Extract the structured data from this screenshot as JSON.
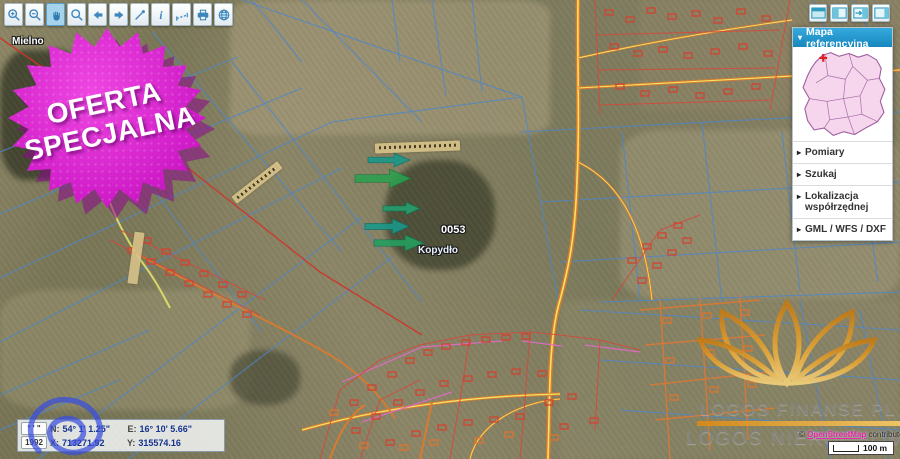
{
  "toolbar": {
    "active_tool": "pan",
    "buttons": [
      {
        "name": "zoom-in",
        "icon": "magnifier-plus-icon"
      },
      {
        "name": "zoom-out",
        "icon": "magnifier-minus-icon"
      },
      {
        "name": "pan",
        "icon": "hand-icon"
      },
      {
        "name": "zoom-extent",
        "icon": "magnifier-icon"
      },
      {
        "name": "previous-view",
        "icon": "arrow-left-icon"
      },
      {
        "name": "next-view",
        "icon": "arrow-right-icon"
      },
      {
        "name": "draw",
        "icon": "pen-icon"
      },
      {
        "name": "identify",
        "icon": "info-icon"
      },
      {
        "name": "measure",
        "icon": "ruler-icon"
      },
      {
        "name": "print",
        "icon": "printer-icon"
      },
      {
        "name": "basemap",
        "icon": "globe-icon"
      }
    ]
  },
  "panel_toggles": [
    {
      "name": "collapse-header",
      "icon": "window-top-icon"
    },
    {
      "name": "dock-left",
      "icon": "panel-left-icon"
    },
    {
      "name": "move-panel",
      "icon": "panel-arrow-right-icon"
    },
    {
      "name": "dock-right",
      "icon": "panel-right-icon"
    }
  ],
  "sidebar": {
    "header": "Mapa referencyjna",
    "header_arrow": "▾",
    "item_arrow": "▸",
    "items": [
      "Pomiary",
      "Szukaj",
      "Lokalizacja współrzędnej",
      "GML / WFS / DXF"
    ]
  },
  "badge": {
    "line1": "OFERTA",
    "line2": "SPECJALNA",
    "color": "#cd18c6"
  },
  "map_labels": {
    "town": "Mielno",
    "parcel_number": "0053",
    "village": "Kopydło"
  },
  "coordinates": {
    "dms_button": "° ' \"",
    "crs_button": "1992",
    "lat_label": "N:",
    "lat_value": "54° 1' 1.25\"",
    "lon_label": "E:",
    "lon_value": "16° 10' 5.66\"",
    "x_label": "X:",
    "x_value": "713271.92",
    "y_label": "Y:",
    "y_value": "315574.16"
  },
  "watermark": {
    "line1": "LOGOS FINANSE PL &",
    "line2": "LOGOS NIERUCHOMOŚCI",
    "gold_color": "#e0a030"
  },
  "attribution": {
    "copyright": "© ",
    "link": "OpenStreetMap",
    "suffix": " contributors"
  },
  "scalebar": {
    "label": "100 m"
  },
  "colors": {
    "accent_blue": "#1d94cf",
    "toolbar_icon": "#3e86bb",
    "cadastral_blue": "#4e86c9",
    "road_orange": "#d97b2e",
    "parcel_red": "#d5402f",
    "arrow_teal": "#18988a",
    "arrow_green": "#2aa04e",
    "link_magenta": "#e727ae",
    "poland_pink": "#f6d6ec"
  }
}
